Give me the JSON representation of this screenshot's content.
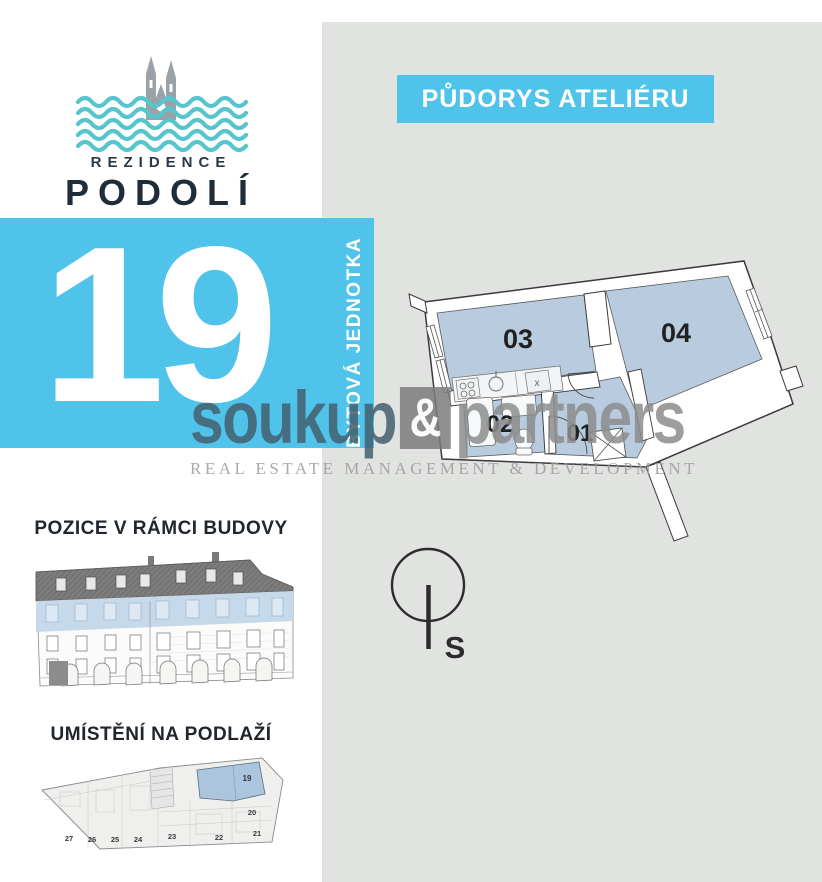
{
  "brand": {
    "name_top": "REZIDENCE",
    "name_bottom": "PODOLÍ"
  },
  "unit": {
    "number": "19",
    "type_label": "BYTOVÁ JEDNOTKA"
  },
  "header": {
    "title": "PŮDORYS ATELIÉRU"
  },
  "floor_plan": {
    "rooms": [
      "03",
      "04",
      "02",
      "01"
    ],
    "shaft_mark": "x"
  },
  "compass": {
    "north_label": "S"
  },
  "sections": {
    "position_title": "POZICE V RÁMCI BUDOVY",
    "floor_title": "UMÍSTĚNÍ NA PODLAŽÍ"
  },
  "floor_map": {
    "units": [
      "27",
      "26",
      "25",
      "24",
      "23",
      "22",
      "21",
      "20"
    ],
    "highlighted_unit": "19"
  },
  "watermark": {
    "word1": "soukup",
    "amp": "&",
    "word2": "partners",
    "subtitle": "REAL ESTATE MANAGEMENT & DEVELOPMENT"
  },
  "colors": {
    "accent_blue": "#4fc3ea",
    "room_fill": "#b9cbdf",
    "highlight_fill": "#abc5de",
    "wave_teal": "#57c5ce",
    "dark_navy": "#1f2d3a",
    "watermark_slate": "#44606f",
    "watermark_gray": "#8d8d8d",
    "panel_gray": "#e1e3e0"
  }
}
